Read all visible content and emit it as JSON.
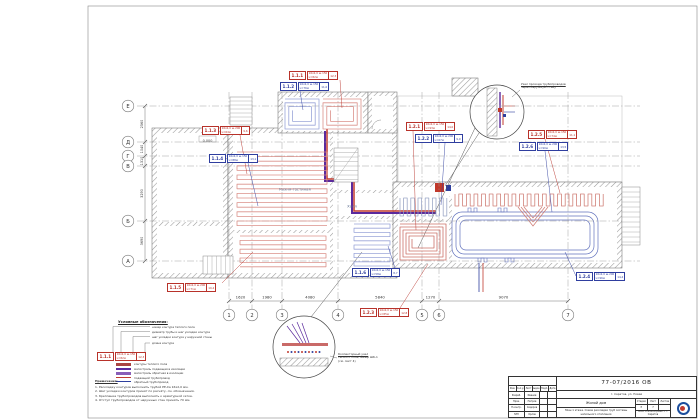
{
  "sheet": {
    "doc_number": "77-07/2016 ОВ",
    "address": "г. Саратов, ул. Новая",
    "object_name": "Жилой дом",
    "sheet_title": "План 1 этажа. Схема раскладки труб системы напольного отопления",
    "stage_labels": [
      "Стадия",
      "Лист",
      "Листов"
    ],
    "stage_values": [
      "Р",
      "7",
      ""
    ],
    "stamp_header": [
      "Изм.",
      "Кол.уч",
      "Лист",
      "№док.",
      "Подп.",
      "Дата"
    ],
    "stamp_rows": [
      [
        "Разраб.",
        "Иванов"
      ],
      [
        "Пров.",
        "Петров"
      ],
      [
        "Н.контр.",
        "Сидоров"
      ],
      [
        "ГИП",
        "Орлов"
      ]
    ],
    "company": "ООО «Тепло-Проект» г. Саратов"
  },
  "grid": {
    "row_labels": [
      "Е",
      "Д",
      "Г",
      "В",
      "Б",
      "А"
    ],
    "row_dims": [
      "2560",
      "1040",
      "1310",
      "3290",
      "3690"
    ],
    "col_labels": [
      "1",
      "2",
      "3",
      "4",
      "5",
      "6",
      "7"
    ],
    "col_dims": [
      "1620",
      "1980",
      "4080",
      "5840",
      "1270",
      "9070"
    ]
  },
  "rooms": [
    "Кухня-гостиная",
    "Холл",
    "0.000"
  ],
  "callouts": [
    {
      "id": "1.1.1",
      "color": "red",
      "spec": "16х2,0 ш.150",
      "len": "L=82м",
      "tail": "12,3"
    },
    {
      "id": "1.1.2",
      "color": "blue",
      "spec": "16х2,0 ш.150",
      "len": "L=76м",
      "tail": "11,0"
    },
    {
      "id": "1.1.3",
      "color": "red",
      "spec": "16х2,0 ш.200",
      "len": "L=64м",
      "tail": "9,6"
    },
    {
      "id": "1.1.4",
      "color": "blue",
      "spec": "16х2,0 ш.150",
      "len": "L=88м",
      "tail": "13,1"
    },
    {
      "id": "1.1.5",
      "color": "red",
      "spec": "16х2,0 ш.200",
      "len": "L=71м",
      "tail": "10,4"
    },
    {
      "id": "1.1.6",
      "color": "blue",
      "spec": "16х2,0 ш.150",
      "len": "L=58м",
      "tail": "8,7"
    },
    {
      "id": "1.2.1",
      "color": "red",
      "spec": "16х2,0 ш.150",
      "len": "L=93м",
      "tail": "14,0"
    },
    {
      "id": "1.2.2",
      "color": "blue",
      "spec": "16х2,0 ш.200",
      "len": "L=67м",
      "tail": "9,9"
    },
    {
      "id": "1.2.3",
      "color": "red",
      "spec": "16х2,0 ш.150",
      "len": "L=85м",
      "tail": "12,8"
    },
    {
      "id": "1.2.4",
      "color": "blue",
      "spec": "16х2,0 ш.200",
      "len": "L=96м",
      "tail": "14,4"
    },
    {
      "id": "1.2.5",
      "color": "red",
      "spec": "16х2,0 ш.150",
      "len": "L=74м",
      "tail": "11,1"
    },
    {
      "id": "1.2.6",
      "color": "blue",
      "spec": "16х2,0 ш.200",
      "len": "L=90м",
      "tail": "13,5"
    }
  ],
  "details": [
    {
      "lines": [
        "Узел прохода трубопроводов",
        "через наружную стену"
      ]
    },
    {
      "lines": [
        "Коллекторный узел",
        "теплого пола, шкаф ШК-1",
        "(см. лист 4)"
      ]
    }
  ],
  "legend": {
    "title": "Условные обозначения:",
    "example": {
      "id": "1.1.1",
      "spec": "16х2,0 ш.150",
      "len": "L=82м",
      "tail": "12,3"
    },
    "pointers": [
      "номер контура теплого пола",
      "диаметр трубы и шаг укладки контура",
      "шаг укладки контура у наружной стены",
      "длина контура"
    ],
    "symbols": [
      {
        "kind": "contour",
        "label": "контуры теплого пола"
      },
      {
        "kind": "supply-main",
        "label": "магистраль подающая в изоляции"
      },
      {
        "kind": "return-main",
        "label": "магистраль обратная в изоляции"
      },
      {
        "kind": "supply",
        "label": "подающий трубопровод"
      },
      {
        "kind": "return",
        "label": "обратный трубопровод"
      }
    ],
    "notes_title": "Примечания:",
    "notes": [
      "1. Раскладку контуров выполнить трубой PE-Xa 16х2,0 мм.",
      "2. Шаг укладки контуров принят по расчёту, см. обозначения.",
      "3. Крепление трубопроводов выполнять к арматурной сетке.",
      "4. Отступ трубопроводов от наружных стен принять 70 мм."
    ]
  }
}
